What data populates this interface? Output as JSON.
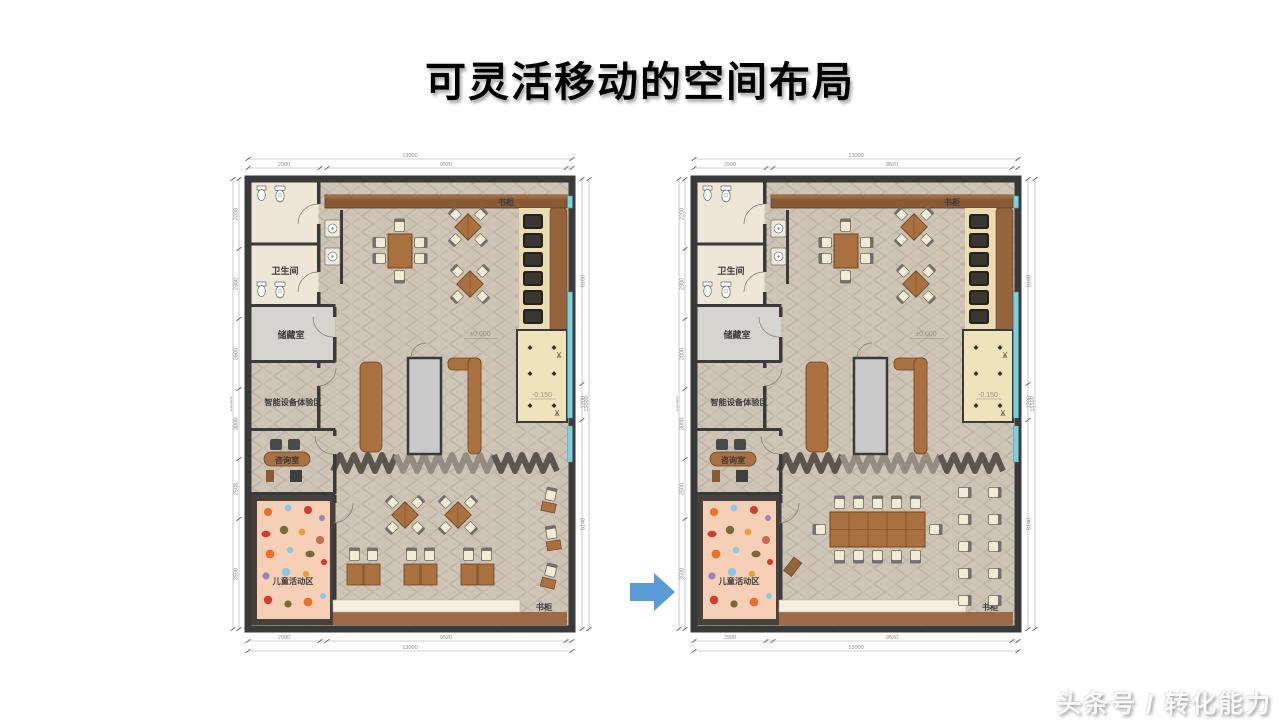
{
  "slide": {
    "title": "可灵活移动的空间布局",
    "watermark": "头条号 / 转化能力",
    "arrow_icon": "right-block-arrow",
    "colors": {
      "arrow": "#5b9bd5",
      "wall": "#3a3a3a",
      "wood": "#a9713f",
      "window": "#7fd0df",
      "tatami": "#efe3bb",
      "kids_mat": "#f5cfb6"
    }
  },
  "plan": {
    "rooms": {
      "bathroom": "卫生间",
      "storage": "储藏室",
      "smart_zone": "智能设备体验区",
      "consult": "咨询室",
      "kids": "儿童活动区",
      "bookcase_top": "书柜",
      "bookcase_bottom": "书柜"
    },
    "elevations": {
      "main": "±0.000",
      "sunken": "-0.150"
    },
    "dims": {
      "top_total": "13000",
      "top_a": "2900",
      "top_b": "9520",
      "left_total": "15500",
      "left_a": "2200",
      "left_b": "2300",
      "left_c": "2000",
      "left_d": "3000",
      "left_e": "2500",
      "left_f": "3500",
      "right_total": "15500",
      "right_a": "6160",
      "right_b": "1200",
      "right_c": "8140"
    }
  }
}
